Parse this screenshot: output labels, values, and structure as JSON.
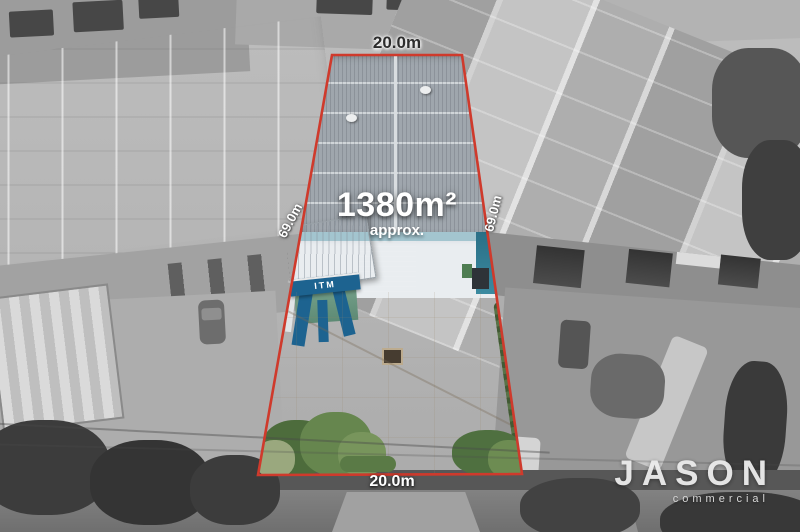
{
  "photo": {
    "dimensions": {
      "top": "20.0m",
      "bottom": "20.0m",
      "left": "69.0m",
      "right": "69.0m"
    },
    "area": {
      "value": "1380m²",
      "qualifier": "approx."
    },
    "building_sign": "ITM",
    "watermark": {
      "brand": "JASON",
      "tagline": "commercial"
    },
    "colors": {
      "boundary_red": "#cf3a2c",
      "itm_blue": "#1d6390",
      "yard_cream": "#e7dcc5",
      "hedge_green": "#5d7c49",
      "roof_gray": "#9fa6ad"
    }
  }
}
